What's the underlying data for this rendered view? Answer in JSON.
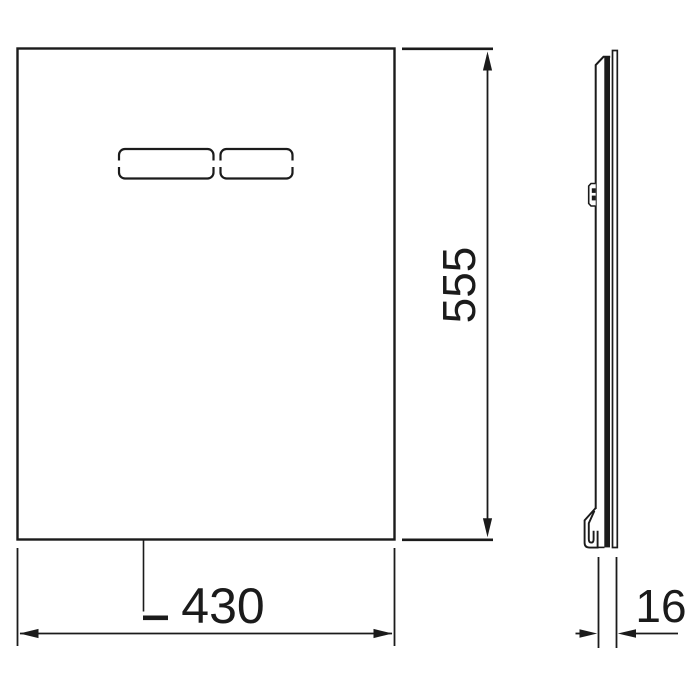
{
  "page": {
    "background": "#ffffff",
    "description": "Technical dimension drawing of a flush plate: front view with two flush buttons and a side profile view"
  },
  "line_color": "#1b1b1b",
  "front_view": {
    "name": "front-view",
    "button_count": 2
  },
  "side_view": {
    "name": "side-profile-view"
  },
  "dimensions": {
    "height": {
      "value": "555"
    },
    "width": {
      "value": "430"
    },
    "depth": {
      "value": "16"
    }
  }
}
